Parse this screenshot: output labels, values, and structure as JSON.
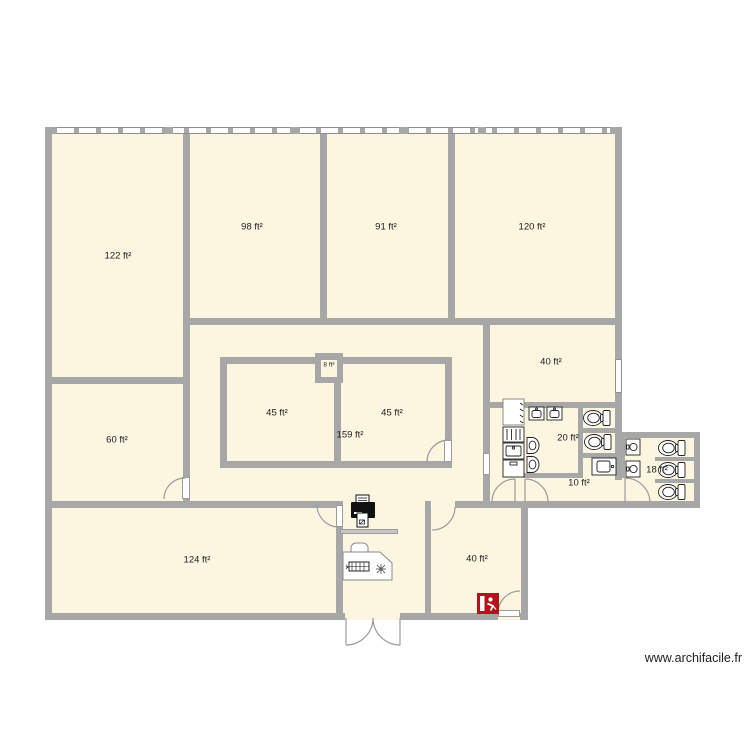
{
  "watermark": {
    "text": "www.archifacile.fr"
  },
  "colors": {
    "background": "#ffffff",
    "wall": "#a7a7a7",
    "floor": "#fcf6e1",
    "door": "#9b9b9b",
    "label_text": "#1c1c1c",
    "fixture_outline": "#222222",
    "exit_sign_red": "#b5121c"
  },
  "rooms": {
    "r122": {
      "label": "122 ft²"
    },
    "r98": {
      "label": "98 ft²"
    },
    "r91": {
      "label": "91 ft²"
    },
    "r120": {
      "label": "120 ft²"
    },
    "r60": {
      "label": "60 ft²"
    },
    "r45a": {
      "label": "45 ft²"
    },
    "r45b": {
      "label": "45 ft²"
    },
    "r159": {
      "label": "159 ft²"
    },
    "r8": {
      "label": "8 ft²"
    },
    "r40mid": {
      "label": "40 ft²"
    },
    "r20": {
      "label": "20 ft²"
    },
    "r10": {
      "label": "10 ft²"
    },
    "r18": {
      "label": "18 ft²"
    },
    "r124": {
      "label": "124 ft²"
    },
    "r40s": {
      "label": "40 ft²"
    }
  },
  "fixtures": {
    "printer": "printer-icon",
    "desk": "desk-with-office-chair",
    "keyboard": "keyboard-icon",
    "plant": "plant-icon",
    "shelf": "wall-shelf",
    "exit_sign": "emergency-exit-sign",
    "toilets_count": 5,
    "urinals_count": 2,
    "sinks_count": 6,
    "kitchenette_column": [
      "fridge",
      "radiator",
      "sink",
      "cabinet"
    ],
    "windows": "window-strip-top-wall"
  }
}
